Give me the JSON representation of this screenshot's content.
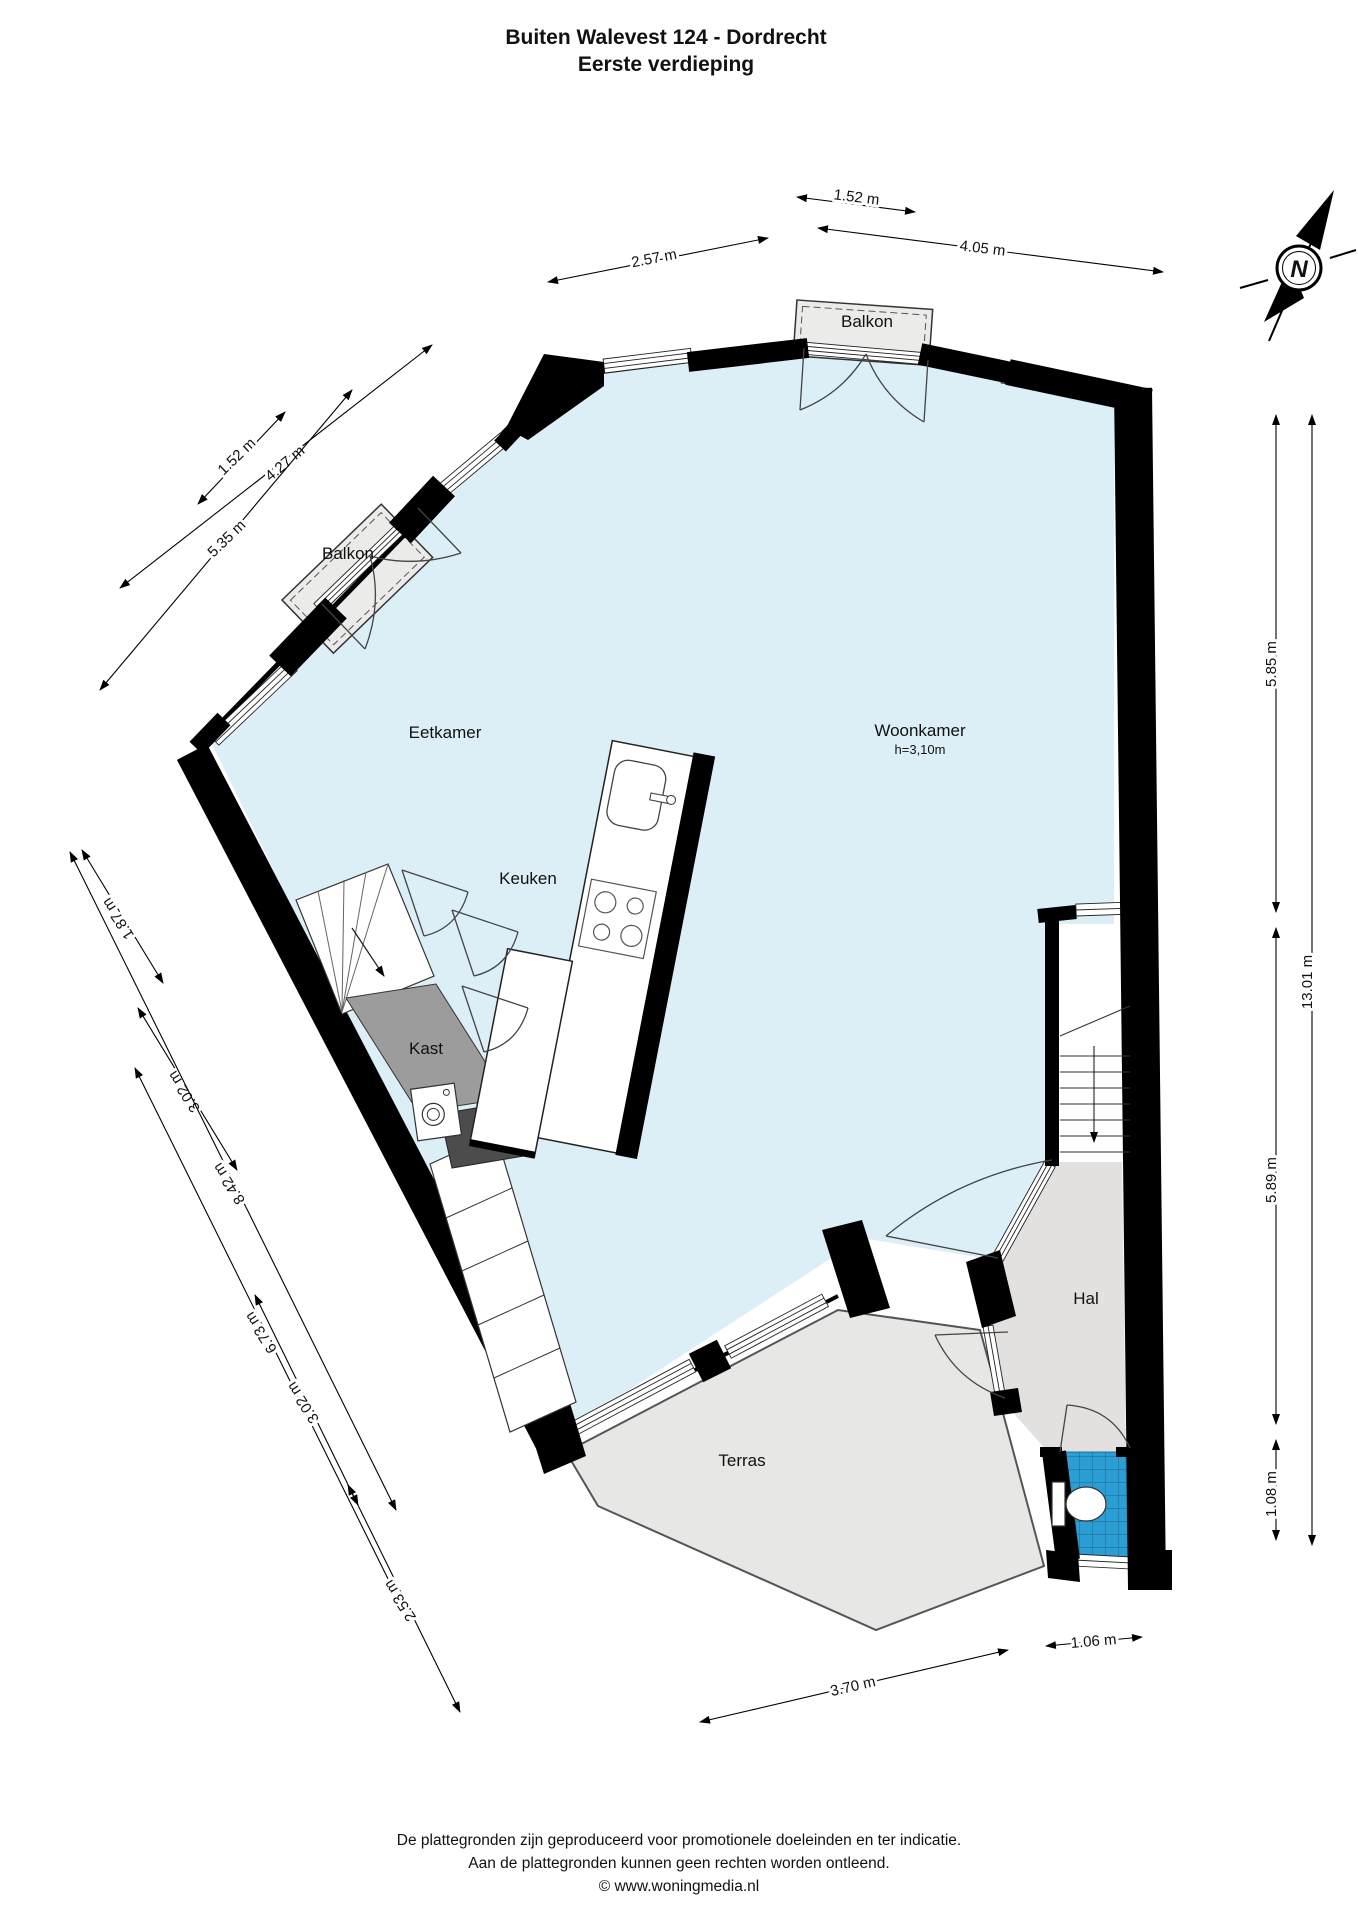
{
  "title": {
    "line1": "Buiten Walevest 124 - Dordrecht",
    "line2": "Eerste verdieping"
  },
  "rooms": {
    "eetkamer": "Eetkamer",
    "keuken": "Keuken",
    "woonkamer": "Woonkamer",
    "woonkamer_height": "h=3,10m",
    "kast": "Kast",
    "hal": "Hal",
    "terras": "Terras",
    "balkon_top": "Balkon",
    "balkon_left": "Balkon"
  },
  "dimensions": {
    "top_152": "1.52 m",
    "top_257": "2.57 m",
    "top_405": "4.05 m",
    "nw_152": "1.52 m",
    "nw_427": "4.27 m",
    "nw_535": "5.35 m",
    "sw_187": "1.87 m",
    "sw_302_upper": "3.02 m",
    "sw_842": "8.42 m",
    "sw_673": "6.73 m",
    "sw_302_lower": "3.02 m",
    "sw_253": "2.53 m",
    "bottom_370": "3.70 m",
    "bottom_106": "1.06 m",
    "right_585": "5.85 m",
    "right_589": "5.89 m",
    "right_108": "1.08 m",
    "right_1301": "13.01 m"
  },
  "compass": {
    "north": "N"
  },
  "colors": {
    "room_fill": "#dceef6",
    "hal_fill": "#e2e1df",
    "terras_fill": "#e7e7e5",
    "balkon_fill": "#ebebe9",
    "kast_fill": "#9c9c9c",
    "counter_fill": "#4c4c4c",
    "tile_blue": "#2d9ed3",
    "wall": "#000000"
  },
  "footer": {
    "line1": "De plattegronden zijn geproduceerd voor promotionele doeleinden en ter indicatie.",
    "line2": "Aan de plattegronden kunnen geen rechten worden ontleend.",
    "line3": "© www.woningmedia.nl"
  }
}
